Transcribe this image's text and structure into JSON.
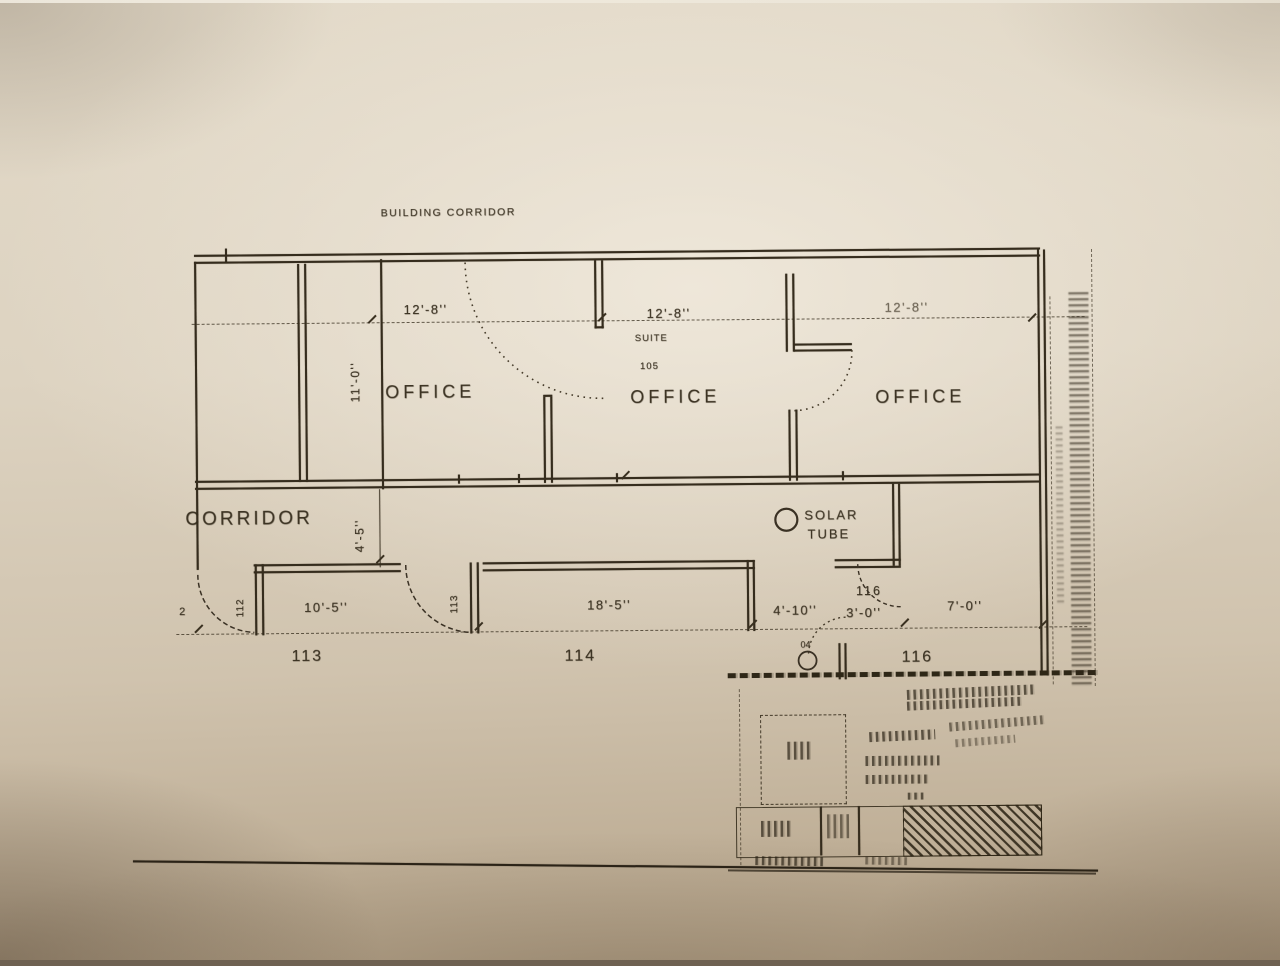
{
  "plan": {
    "building_corridor_label": "BUILDING CORRIDOR",
    "offices": {
      "left": {
        "label": "OFFICE",
        "width_dim": "12'-8''"
      },
      "middle": {
        "label": "OFFICE",
        "width_dim": "12'-8''",
        "suite_label": "SUITE",
        "suite_number": "105"
      },
      "right": {
        "label": "OFFICE",
        "width_dim": "12'-8''"
      },
      "depth_dim": "11'-0''"
    },
    "corridor": {
      "label": "CORRIDOR",
      "width_dim": "4'-5''"
    },
    "solar_tube": {
      "line1": "SOLAR",
      "line2": "TUBE"
    },
    "lower_rooms": {
      "door_112": "112",
      "room_113": {
        "label": "113",
        "width_dim": "10'-5''",
        "door_number": "113"
      },
      "room_114": {
        "label": "114",
        "width_dim": "18'-5''"
      },
      "room_116": {
        "label": "116",
        "door_number": "116",
        "dim_a": "4'-10''",
        "dim_b": "3'-0''",
        "dim_c": "7'-0''",
        "keynote": "04"
      },
      "left_mark": "2"
    }
  }
}
